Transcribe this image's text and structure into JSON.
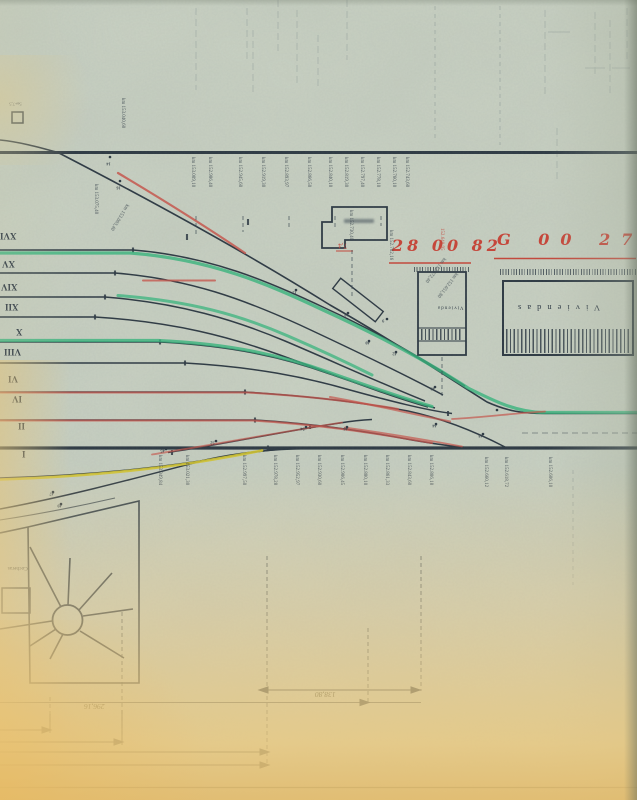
{
  "annotations": {
    "red_left": "28 00 82",
    "red_right": "G 00 27",
    "red_vertical": "152.640,95",
    "red_width": "7,4"
  },
  "buildings": {
    "large": "Viviendas",
    "small": "Vivienda",
    "depot": "Cocheras",
    "hut": "5a+7,5"
  },
  "dimensions": {
    "long": "296,16",
    "short": "138,80"
  },
  "tracks": {
    "numerals": [
      "XVI",
      "XV",
      "XIV",
      "XII",
      "X",
      "VIII",
      "VI",
      "IV",
      "II",
      "I"
    ]
  },
  "mileposts": {
    "top": [
      "km 153.009,10",
      "km 152.986,40",
      "km 152.945,60",
      "km 152.919,30",
      "km 152.893,97",
      "km 152.866,50",
      "km 152.840,10",
      "km 152.819,30",
      "km 152.797,40",
      "km 152.778,10",
      "km 152.760,10",
      "km 152.743,60"
    ],
    "bottom": [
      "km 153.049,84",
      "km 153.021,30",
      "km 152.997,50",
      "km 152.978,28",
      "km 152.952,97",
      "km 152.930,60",
      "km 152.906,45",
      "km 152.880,10",
      "km 152.861,33",
      "km 152.843,60",
      "km 152.806,18",
      "km 152.660,12",
      "km 152.618,72",
      "km 152.606,10"
    ],
    "extra": [
      "km 153.040,60",
      "km 153.075,40",
      "km 153.063,40",
      "km 152.730,40",
      "km 152.702,16",
      "km 152.672,40",
      "km 152.651,80"
    ]
  },
  "switches": [
    "14",
    "16",
    "12",
    "10",
    "9",
    "40",
    "42",
    "43",
    "44",
    "46",
    "45",
    "52",
    "54",
    "48",
    "47",
    "49"
  ],
  "colors": {
    "paper": "#cbd3c5",
    "ink": "#2e3a44",
    "red": "#c5473b",
    "green": "#37b57d",
    "yellow": "#d3c532",
    "tan": "#e8c98e"
  }
}
